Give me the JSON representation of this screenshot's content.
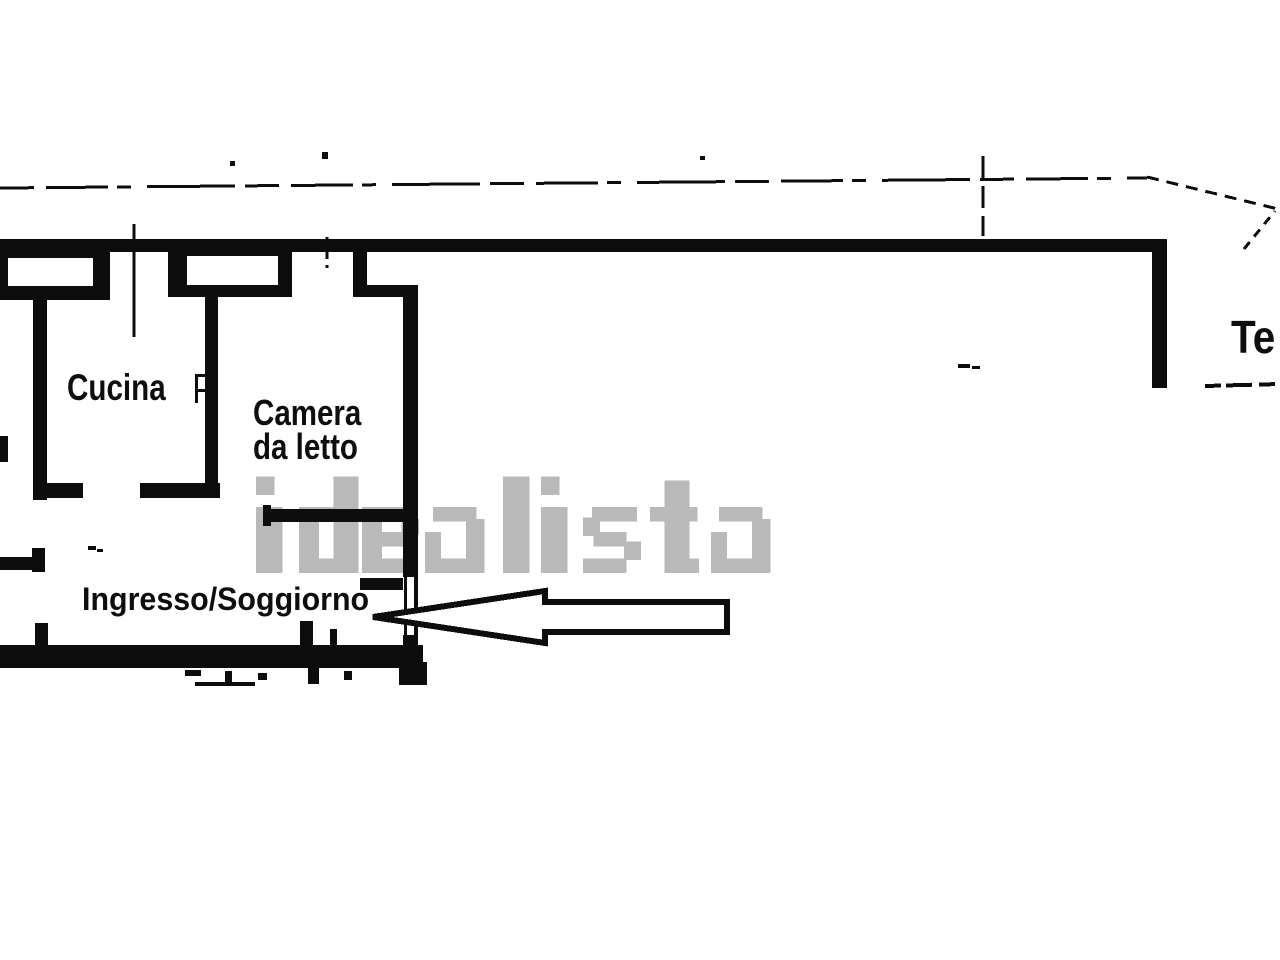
{
  "watermark": {
    "text": "idealista",
    "color": "#b9b9b9"
  },
  "rooms": {
    "kitchen": {
      "label": "Cucina"
    },
    "bedroom": {
      "label_line1": "Camera",
      "label_line2": "da letto"
    },
    "entrance_living_room": {
      "label": "Ingresso/Soggiorno"
    },
    "terrace": {
      "label_partial": "Te"
    }
  },
  "colors": {
    "ink": "#0d0d0d",
    "background": "#ffffff",
    "watermark": "#b9b9b9"
  }
}
